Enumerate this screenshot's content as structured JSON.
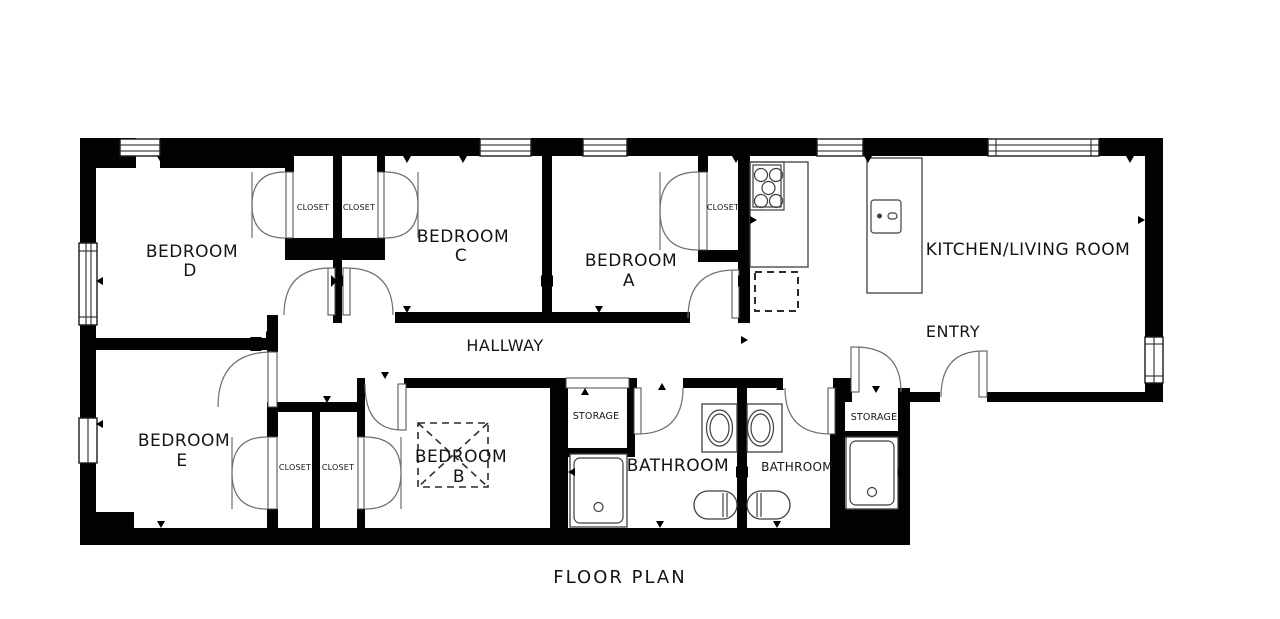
{
  "title": "FLOOR PLAN",
  "rooms": {
    "bedroom_d": {
      "line1": "BEDROOM",
      "line2": "D"
    },
    "bedroom_c": {
      "line1": "BEDROOM",
      "line2": "C"
    },
    "bedroom_a": {
      "line1": "BEDROOM",
      "line2": "A"
    },
    "bedroom_b": {
      "line1": "BEDROOM",
      "line2": "B"
    },
    "bedroom_e": {
      "line1": "BEDROOM",
      "line2": "E"
    },
    "kitchen_living": {
      "label": "KITCHEN/LIVING ROOM"
    },
    "hallway": {
      "label": "HALLWAY"
    },
    "entry": {
      "label": "ENTRY"
    },
    "bathroom_1": {
      "label": "BATHROOM"
    },
    "bathroom_2": {
      "label": "BATHROOM"
    },
    "storage_1": {
      "label": "STORAGE"
    },
    "storage_2": {
      "label": "STORAGE"
    },
    "closet_top_1": {
      "label": "CLOSET"
    },
    "closet_top_2": {
      "label": "CLOSET"
    },
    "closet_a": {
      "label": "CLOSET"
    },
    "closet_bottom_1": {
      "label": "CLOSET"
    },
    "closet_bottom_2": {
      "label": "CLOSET"
    }
  },
  "colors": {
    "wall": "#030303",
    "line": "#3f3f3f",
    "background": "#ffffff",
    "text": "#141414"
  }
}
